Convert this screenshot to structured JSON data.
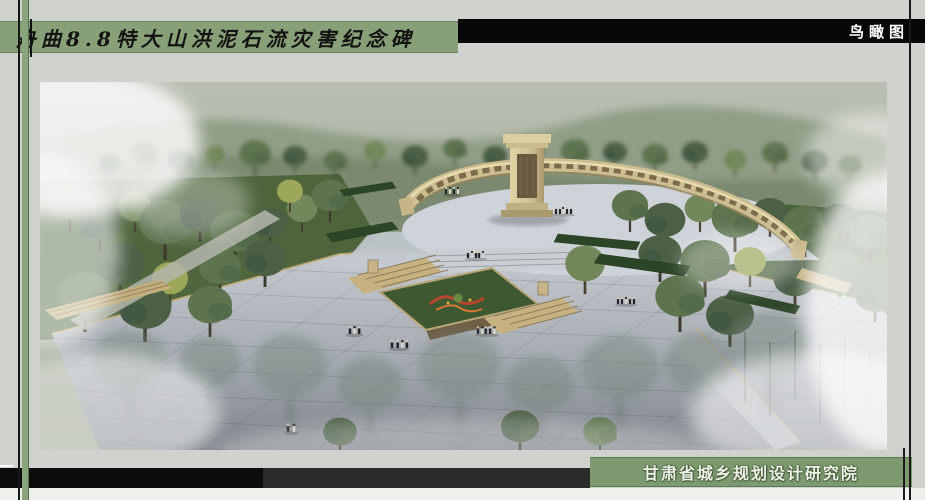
{
  "board": {
    "background_color": "#d0d3cd",
    "title_banner": {
      "text": "舟曲8.8特大山洪泥石流灾害纪念碑",
      "bg": "#87a078",
      "fg": "#131313"
    },
    "view_label": {
      "text": "鸟瞰图",
      "bg": "#080808",
      "fg": "#ffffff"
    },
    "institute_banner": {
      "text": "甘肃省城乡规划设计研究院",
      "bg": "#7e9a71",
      "fg": "#eef2e8"
    },
    "frame": {
      "line_color": "#161616",
      "accent_stripe_color": "#8aa47e"
    }
  },
  "rendering_palette": {
    "stone_wall": "#cdbd90",
    "plaza_light": "#c9ced4",
    "plaza_dark": "#82888e",
    "lawn": "#4a6138",
    "tree_dark": "#4c6045",
    "flower_red": "#b5452c",
    "fog": "#ffffff"
  }
}
